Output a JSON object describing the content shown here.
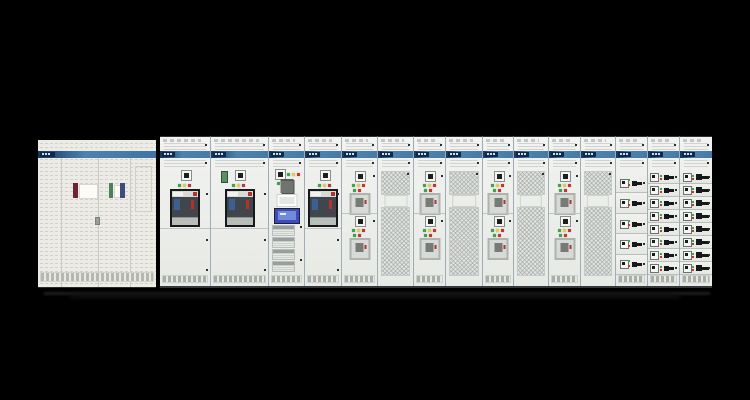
{
  "scene": {
    "kind": "product-photo",
    "subject": "low-voltage switchboard cabinet lineup",
    "background": "#000000",
    "legible_text": false
  },
  "colors": {
    "panel": "#ecebe6",
    "slot": "#cfd4d0",
    "band1": "#16365e",
    "band2": "#4d82b0",
    "chip": "#10294a",
    "ledg": "#3fa34d",
    "ledy": "#e0cc4e",
    "ledr": "#c63430",
    "dark": "#17191c",
    "acbface": "#c9ccc8",
    "acbmid": "#41464c",
    "acbred": "#b5312c",
    "acbblue": "#3e5f93",
    "hmiframe": "#241d2e",
    "hmiscreen": "#3a4cc0",
    "hmiinner": "#7d97dd",
    "cube": "#6f746d",
    "gdev": "#5d8f63",
    "maroon": "#6b2430",
    "lgreen": "#4e7e5c",
    "lnavy": "#3c4c7c",
    "mesh1": "#e2e5e2",
    "handle": "#16181a"
  },
  "left_cabinet": {
    "panels": 4,
    "brand_band": true,
    "door_labels": [
      {
        "style": "dark-red-stripe-with-white-card"
      },
      {
        "style": "green-stripe-card"
      },
      {
        "style": "navy-stripe-card"
      }
    ]
  },
  "lineup": {
    "section_count": 15,
    "led_sequence_row1": [
      "green",
      "yellow",
      "red"
    ],
    "led_sequence_row2": [
      "green",
      "red"
    ],
    "sections": [
      {
        "type": "acb",
        "width": 50,
        "variant": "plain"
      },
      {
        "type": "acb",
        "width": 58,
        "variant": "green-device"
      },
      {
        "type": "control",
        "width": 36
      },
      {
        "type": "acb",
        "width": 37,
        "variant": "plain"
      },
      {
        "type": "mcc2",
        "width": 36
      },
      {
        "type": "mesh",
        "width": 36
      },
      {
        "type": "mcc2",
        "width": 32
      },
      {
        "type": "mesh",
        "width": 37
      },
      {
        "type": "mcc2",
        "width": 31
      },
      {
        "type": "mesh",
        "width": 35
      },
      {
        "type": "mcc2",
        "width": 32
      },
      {
        "type": "mesh",
        "width": 35
      },
      {
        "type": "drawers",
        "width": 32,
        "rows": 5,
        "size": "tall"
      },
      {
        "type": "drawers",
        "width": 32,
        "rows": 8,
        "size": "compact"
      },
      {
        "type": "drawers",
        "width": 33,
        "rows": 8,
        "size": "wide"
      }
    ]
  }
}
